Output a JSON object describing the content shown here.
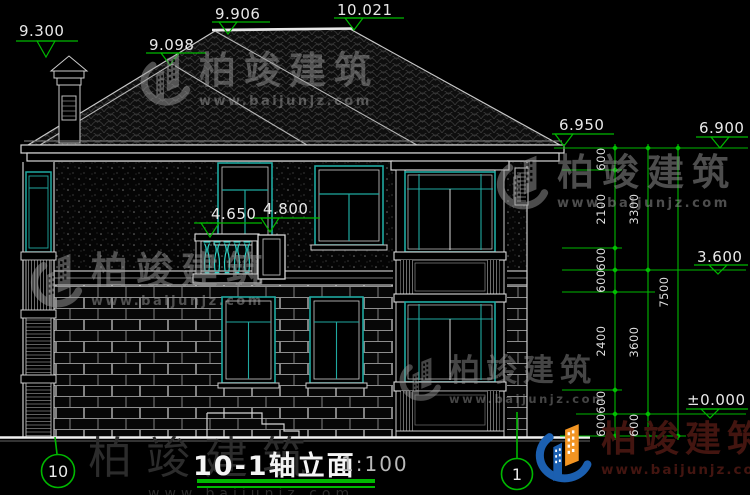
{
  "drawing": {
    "title": "10-1轴立面",
    "scale": "1:100",
    "axis_left": "10",
    "axis_right": "1"
  },
  "elevations": {
    "roof_left": "9.300",
    "hip": "9.098",
    "ridge_left": "9.906",
    "ridge_right": "10.021",
    "eave_left": "6.950",
    "eave_right": "6.900",
    "second_floor": "3.600",
    "ground": "±0.000",
    "balcony_rail": "4.650",
    "balcony_door": "4.800"
  },
  "dimensions": {
    "chain_inner": [
      "600",
      "2100",
      "600",
      "600",
      "2400",
      "600",
      "600"
    ],
    "chain_middle": [
      "3300",
      "3600",
      "600"
    ],
    "chain_outer": [
      "7500"
    ]
  },
  "watermark": {
    "brand": "柏竣建筑",
    "url": "www.baijunjz.com"
  },
  "colors": {
    "dimension_green": "#00b800",
    "window_teal": "#1fa9a1",
    "line_white": "#dcdcdc",
    "logo_blue": "#1b5fb0",
    "logo_orange": "#f29422",
    "brand_dark_red": "#431510"
  }
}
